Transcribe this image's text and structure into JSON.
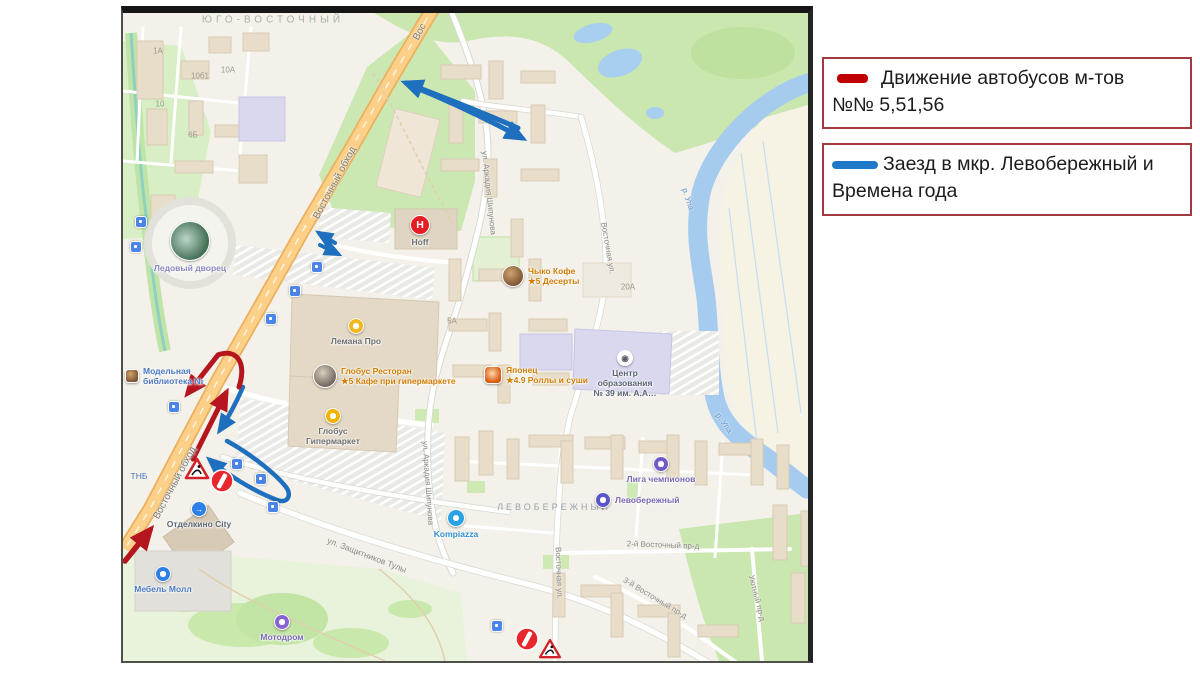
{
  "legend": {
    "items": [
      {
        "swatch_color": "#c00000",
        "line1": "Движение автобусов м-тов",
        "line2": "№№ 5,51,56"
      },
      {
        "swatch_color": "#1f78c8",
        "line1": "Заезд в мкр. Левобережный и",
        "line2": "Времена года"
      }
    ]
  },
  "map": {
    "annotation_colors": {
      "bus_route_red": "#b5161d",
      "detour_blue": "#1e6fbe"
    },
    "district_labels": [
      {
        "text": "ЮГО-ВОСТОЧНЫЙ",
        "x": 150,
        "y": 7,
        "ls": 4,
        "size": 10,
        "color": "#aab2a4"
      },
      {
        "text": "ЛЕВОБЕРЕЖНЫЙ",
        "x": 431,
        "y": 494,
        "ls": 3,
        "size": 9,
        "color": "#9aa4ae"
      }
    ],
    "labels": [
      {
        "text": "Восточный обход",
        "x": 212,
        "y": 170,
        "rot": -62,
        "size": 10,
        "color": "#7d7d78"
      },
      {
        "text": "Восточный обход",
        "x": 52,
        "y": 470,
        "rot": -62,
        "size": 10,
        "color": "#7d7d78"
      },
      {
        "text": "Вос",
        "x": 297,
        "y": 19,
        "rot": -62,
        "size": 10,
        "color": "#7d7d78"
      },
      {
        "text": "ул. Аркадия Шипунова",
        "x": 366,
        "y": 180,
        "rot": 84,
        "size": 8
      },
      {
        "text": "ул. Аркадия Шипунова",
        "x": 305,
        "y": 470,
        "rot": 86,
        "size": 8
      },
      {
        "text": "Восточная ул.",
        "x": 485,
        "y": 235,
        "rot": 80,
        "size": 8
      },
      {
        "text": "Восточная ул.",
        "x": 436,
        "y": 560,
        "rot": 88,
        "size": 8
      },
      {
        "text": "ул. Защитников Тулы",
        "x": 244,
        "y": 542,
        "rot": 21,
        "size": 8.5
      },
      {
        "text": "2-й Восточный пр-д",
        "x": 540,
        "y": 532,
        "rot": 2,
        "size": 8
      },
      {
        "text": "3-й Восточный пр-д",
        "x": 532,
        "y": 585,
        "rot": 31,
        "size": 8
      },
      {
        "text": "Уютный пр-д",
        "x": 634,
        "y": 585,
        "rot": 76,
        "size": 8
      },
      {
        "text": "р. Упа",
        "x": 565,
        "y": 186,
        "rot": 72,
        "size": 8,
        "color": "#5f96d6"
      },
      {
        "text": "р. Упа",
        "x": 601,
        "y": 410,
        "rot": 55,
        "size": 8,
        "color": "#5f96d6"
      },
      {
        "text": "ТНБ",
        "x": 16,
        "y": 463,
        "rot": 0,
        "size": 8.5,
        "color": "#4a78c0"
      }
    ],
    "poi": [
      {
        "id": "ledovy-dvorets",
        "type": "photo",
        "grad": "radial-gradient(circle at 40% 45%, #bcd6c8, #3f6d52 72%)",
        "x": 67,
        "y": 228,
        "r": 20,
        "lines": [
          "Ледовый дворец"
        ],
        "lp": "below",
        "lc": "#8a87c0"
      },
      {
        "id": "modelnaya-biblioteka",
        "type": "photo",
        "shape": "square",
        "x": 9,
        "y": 363,
        "r": 7,
        "lines": [
          "Модельная",
          "библиотека №"
        ],
        "lp": "right",
        "lc": "#4a78c0"
      },
      {
        "id": "otdelkino-city",
        "type": "dot",
        "color": "#2f7fe8",
        "glyph": "→",
        "x": 76,
        "y": 496,
        "r": 8,
        "lines": [
          "Отделкино City"
        ],
        "lp": "below",
        "lc": "#5a6472"
      },
      {
        "id": "mebel-moll",
        "type": "dot",
        "color": "#2f7fe8",
        "x": 40,
        "y": 561,
        "r": 8,
        "lines": [
          "Мебель Молл"
        ],
        "lp": "below",
        "lc": "#4a78c0"
      },
      {
        "id": "motodrom",
        "type": "dot",
        "color": "#8a63d2",
        "x": 159,
        "y": 609,
        "r": 8,
        "lines": [
          "Мотодром"
        ],
        "lp": "below",
        "lc": "#7b68b5"
      },
      {
        "id": "hoff",
        "type": "dot",
        "color": "#e31e24",
        "glyph": "H",
        "x": 297,
        "y": 212,
        "r": 10,
        "lines": [
          "Hoff"
        ],
        "lp": "below",
        "lc": "#6e6e6e"
      },
      {
        "id": "lemana-pro",
        "type": "dot",
        "color": "#f3b81f",
        "x": 233,
        "y": 313,
        "r": 8,
        "lines": [
          "Лемана Про"
        ],
        "lp": "below",
        "lc": "#6e6e6e"
      },
      {
        "id": "globus-restoran",
        "type": "photo",
        "grad": "radial-gradient(circle at 40% 35%, #d8cfc0, #6e6258 75%)",
        "x": 202,
        "y": 363,
        "r": 12,
        "lines": [
          "Глобус Ресторан",
          "★5 Кафе при гипермаркете"
        ],
        "lp": "right",
        "lc": "#d07d00"
      },
      {
        "id": "globus-gipermarket",
        "type": "dot",
        "color": "#f0b400",
        "x": 210,
        "y": 403,
        "r": 8,
        "lines": [
          "Глобус",
          "Гипермаркет"
        ],
        "lp": "below",
        "lc": "#6e6e6e"
      },
      {
        "id": "chyko-kofe",
        "type": "photo",
        "x": 390,
        "y": 263,
        "r": 11,
        "lines": [
          "Чыко Кофе",
          "★5 Десерты"
        ],
        "lp": "right",
        "lc": "#d07d00"
      },
      {
        "id": "yaponets",
        "type": "photo",
        "shape": "square",
        "grad": "radial-gradient(circle at 45% 40%, #ffd9b0, #d85a10 70%)",
        "x": 370,
        "y": 362,
        "r": 9,
        "lines": [
          "Японец",
          "★4.9 Роллы и суши"
        ],
        "lp": "right",
        "lc": "#d07d00"
      },
      {
        "id": "tsentr-obrazovaniya",
        "type": "dot",
        "color": "#ffffff",
        "glyph": "◉",
        "gc": "#5a5a66",
        "x": 502,
        "y": 345,
        "r": 8,
        "lines": [
          "Центр",
          "образования",
          "№ 39 им. А.А…"
        ],
        "lp": "below",
        "lc": "#5a6472"
      },
      {
        "id": "liga-chempionov",
        "type": "dot",
        "color": "#7459c8",
        "x": 538,
        "y": 451,
        "r": 8,
        "lines": [
          "Лига чемпионов"
        ],
        "lp": "below",
        "lc": "#7b68b5"
      },
      {
        "id": "levoberezhny",
        "type": "dot",
        "color": "#5b55c9",
        "x": 480,
        "y": 487,
        "r": 8,
        "lines": [
          "Левобережный"
        ],
        "lp": "right",
        "lc": "#7b68b5"
      },
      {
        "id": "kompiazza",
        "type": "dot",
        "color": "#29a3e3",
        "x": 333,
        "y": 505,
        "r": 9,
        "lines": [
          "Kompiazza"
        ],
        "lp": "below",
        "lc": "#2f8fd0"
      }
    ],
    "house_numbers": [
      {
        "text": "1А",
        "x": 35,
        "y": 38
      },
      {
        "text": "10б1",
        "x": 77,
        "y": 63
      },
      {
        "text": "10А",
        "x": 105,
        "y": 57
      },
      {
        "text": "6Б",
        "x": 70,
        "y": 122
      },
      {
        "text": "10",
        "x": 37,
        "y": 91
      },
      {
        "text": "20А",
        "x": 505,
        "y": 274
      },
      {
        "text": "5А",
        "x": 329,
        "y": 308
      }
    ],
    "transit_stops": [
      {
        "x": 172,
        "y": 278
      },
      {
        "x": 148,
        "y": 306
      },
      {
        "x": 51,
        "y": 394
      },
      {
        "x": 114,
        "y": 451
      },
      {
        "x": 138,
        "y": 466
      },
      {
        "x": 150,
        "y": 494
      },
      {
        "x": 374,
        "y": 613
      },
      {
        "x": 18,
        "y": 209
      },
      {
        "x": 13,
        "y": 234
      },
      {
        "x": 194,
        "y": 254
      }
    ]
  }
}
